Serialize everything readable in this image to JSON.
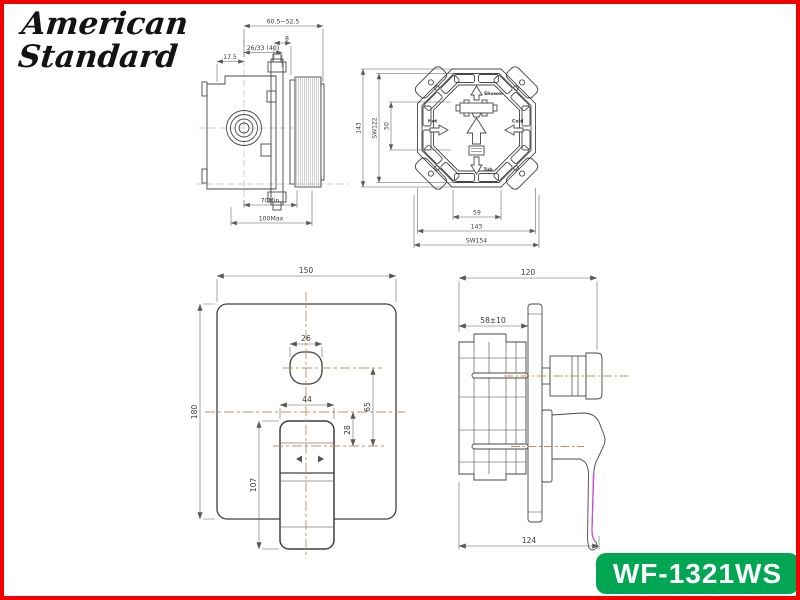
{
  "window": {
    "bg": "#ffffff",
    "border_color": "#ee0202"
  },
  "brand": {
    "line1": "American",
    "line2": "Standard"
  },
  "badge": {
    "label": "WF-1321WS",
    "bg": "#00a651",
    "fg": "#ffffff"
  },
  "colors": {
    "drawing_line": "#474747",
    "dimension_line": "#5a5a5a",
    "dimension_text": "#3a3a3a",
    "centerline_orange": "#cc8d5e",
    "handle_accent_magenta": "#c94fd4"
  },
  "valve_top_view": {
    "dims": {
      "embed_range": "60.5~52.5",
      "stub": "8",
      "cover": "26/33 (40)",
      "edge_to_axis": "17.5",
      "depth_min": "70Min",
      "depth_max": "100Max"
    }
  },
  "rough_in_front_view": {
    "ports": {
      "top": "Shower",
      "left": "Hot",
      "right": "Cold",
      "bottom": "Tub"
    },
    "dims": {
      "body_height": "143",
      "flats_vertical": "SW122",
      "port_spacing_v": "50",
      "port_spacing_h": "59",
      "body_width": "143",
      "flats_horizontal": "SW154"
    }
  },
  "trim_front_view": {
    "dims": {
      "plate_width": "150",
      "plate_height": "180",
      "knob_width": "26",
      "handle_width": "44",
      "knob_to_pivot": "65",
      "center_to_pivot": "28",
      "handle_length": "107"
    }
  },
  "trim_side_view": {
    "dims": {
      "projection": "120",
      "wall_depth": "58±10",
      "total_depth": "124"
    }
  }
}
